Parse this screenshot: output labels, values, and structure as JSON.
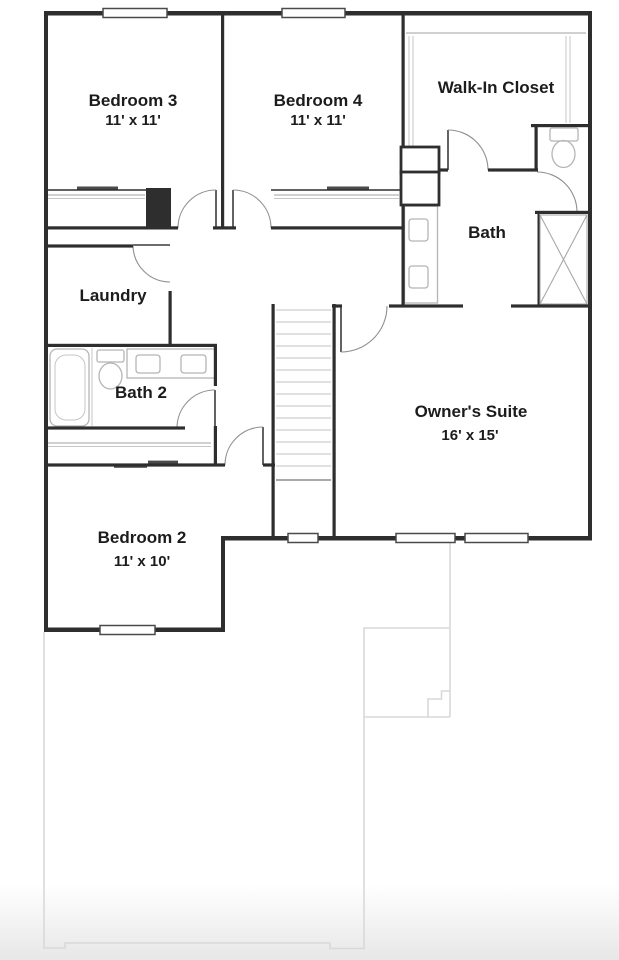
{
  "floor_plan": {
    "rooms": [
      {
        "id": "bedroom3",
        "name": "Bedroom 3",
        "dims": "11' x 11'"
      },
      {
        "id": "bedroom4",
        "name": "Bedroom 4",
        "dims": "11' x 11'"
      },
      {
        "id": "walk_in_closet",
        "name": "Walk-In Closet",
        "dims": ""
      },
      {
        "id": "bath",
        "name": "Bath",
        "dims": ""
      },
      {
        "id": "laundry",
        "name": "Laundry",
        "dims": ""
      },
      {
        "id": "bath2",
        "name": "Bath 2",
        "dims": ""
      },
      {
        "id": "owners_suite",
        "name": "Owner's Suite",
        "dims": "16' x 15'"
      },
      {
        "id": "bedroom2",
        "name": "Bedroom 2",
        "dims": "11' x 10'"
      }
    ],
    "colors": {
      "wall": "#2e2e2e",
      "fixture": "#b5b5b5",
      "ghost_outline": "#d9d9d9",
      "label_text": "#1c1c1c",
      "background": "#ffffff"
    }
  }
}
